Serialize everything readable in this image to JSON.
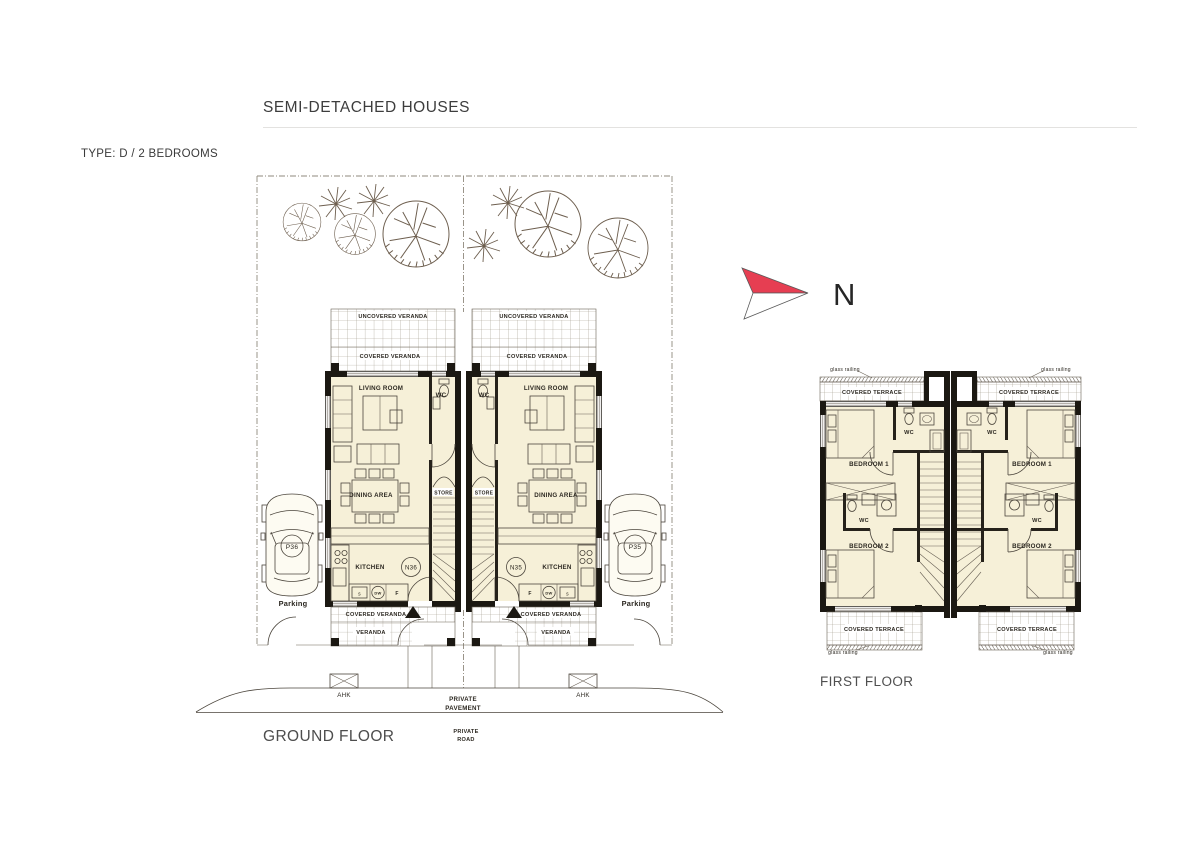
{
  "header": {
    "title": "SEMI-DETACHED HOUSES",
    "type_label": "TYPE: D / 2 BEDROOMS"
  },
  "north": {
    "label": "N"
  },
  "ground_floor": {
    "caption": "GROUND FLOOR",
    "rooms": {
      "living_room": "LIVING ROOM",
      "dining_area": "DINING AREA",
      "kitchen": "KITCHEN",
      "wc": "WC",
      "store": "STORE"
    },
    "outdoor": {
      "uncovered_veranda": "UNCOVERED VERANDA",
      "covered_veranda": "COVERED VERANDA",
      "veranda": "VERANDA",
      "parking": "Parking",
      "ahk": "AHK",
      "private_pavement_line1": "PRIVATE",
      "private_pavement_line2": "PAVEMENT",
      "private_road_line1": "PRIVATE",
      "private_road_line2": "ROAD"
    },
    "appliances": {
      "dishwasher": "DW",
      "fridge": "F",
      "sink": "s"
    },
    "units": [
      {
        "house_no": "N36",
        "parking_no": "P36"
      },
      {
        "house_no": "N35",
        "parking_no": "P35"
      }
    ]
  },
  "first_floor": {
    "caption": "FIRST FLOOR",
    "rooms": {
      "bedroom_1": "BEDROOM 1",
      "bedroom_2": "BEDROOM 2",
      "wc": "WC"
    },
    "outdoor": {
      "covered_terrace": "COVERED TERRACE",
      "glass_railing": "glass railing"
    }
  },
  "colors": {
    "floor_fill": "#f6f0d8",
    "wall": "#1b1812",
    "north_red": "#e63e52",
    "line": "#4b453c"
  }
}
